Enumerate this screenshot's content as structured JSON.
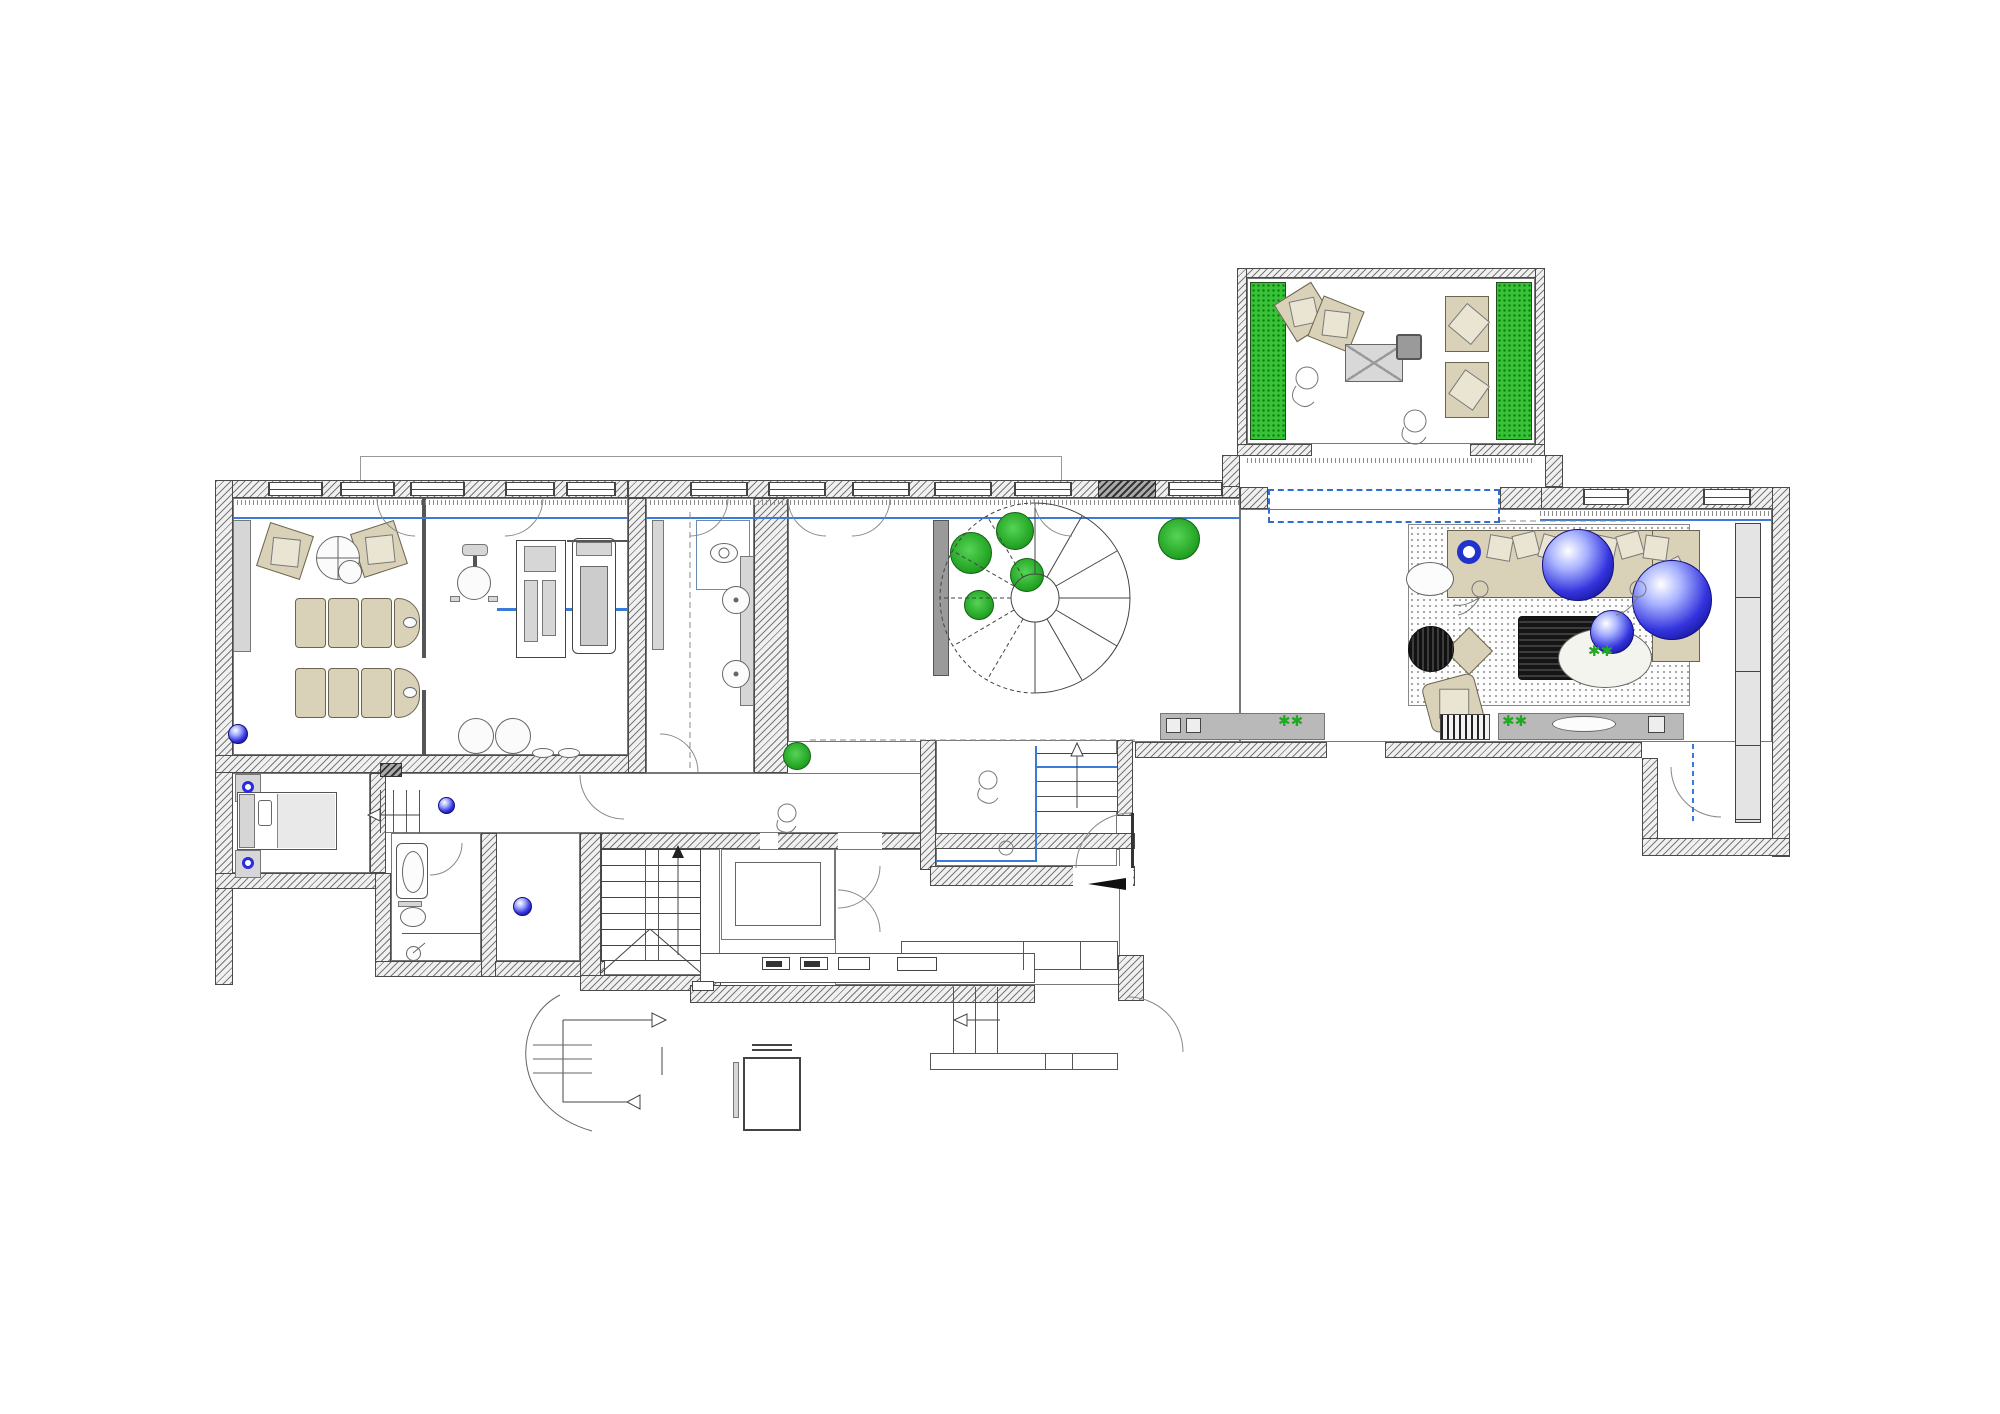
{
  "title": "residential-floor-plan",
  "colors": {
    "room_label": "#1d1d96",
    "glazing_blue": "#3a7bd5",
    "dashed_opening_blue": "#2e6fd0",
    "sphere_blue": "#2424dd",
    "plant_green": "#29b329",
    "power_note_red": "#e03434",
    "furniture_beige": "#d9d2b8",
    "wall_gray": "#4a4a4a"
  },
  "rooms": [
    {
      "name": "VARANDA",
      "area": "17.75m2"
    },
    {
      "name": "SALA ESTAR",
      "area": "72.85m2"
    },
    {
      "name": "LAVABO SOCIAL",
      "area": "13.95m2"
    },
    {
      "name": "CIRC.",
      "area": "16.85m2"
    },
    {
      "name": "CIRC.",
      "area": "8.00m2"
    },
    {
      "name": "HALL",
      "area": "10.90m2"
    },
    {
      "name": "LAVANDARIA",
      "area": "3.65m2"
    },
    {
      "name": "COZINHA",
      "area": "19.00m2"
    }
  ],
  "notes": {
    "gym_power": [
      "220v=30a",
      "220v=30a",
      "220v=30a"
    ]
  },
  "stairs": {
    "main_left": [
      "01",
      "02",
      "03",
      "04",
      "05",
      "06",
      "07"
    ],
    "main_right": [
      "17",
      "16",
      "15",
      "14",
      "13",
      "12",
      "11",
      "10"
    ],
    "main_mid": [
      "08",
      "09"
    ],
    "hall_steps": [
      "05",
      "04",
      "03",
      "02",
      "01"
    ],
    "corridor_steps": [
      "04",
      "03",
      "02",
      "01"
    ]
  }
}
